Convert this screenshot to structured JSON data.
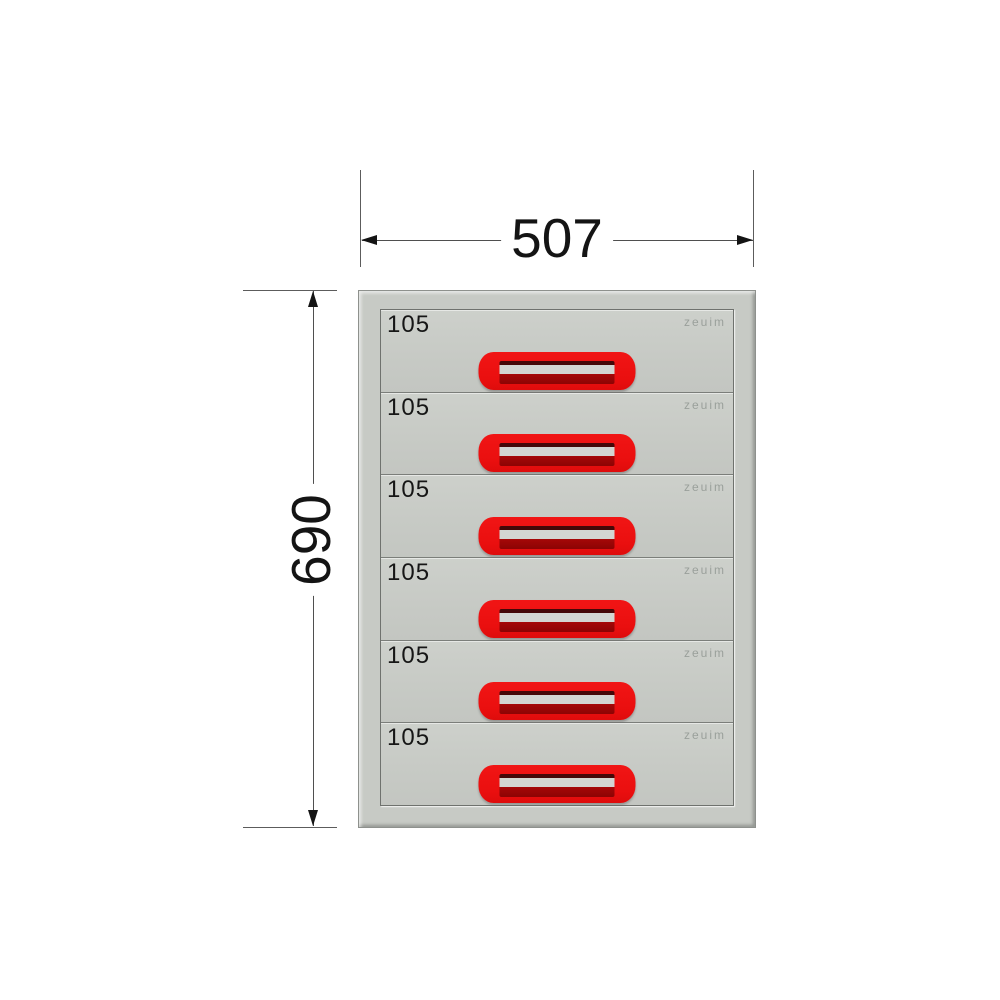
{
  "diagram": {
    "width_dimension": {
      "label": "507"
    },
    "height_dimension": {
      "label": "690"
    },
    "cabinet": {
      "drawer_count": 6,
      "drawers": [
        {
          "height_label": "105",
          "logo": "zeuim"
        },
        {
          "height_label": "105",
          "logo": "zeuim"
        },
        {
          "height_label": "105",
          "logo": "zeuim"
        },
        {
          "height_label": "105",
          "logo": "zeuim"
        },
        {
          "height_label": "105",
          "logo": "zeuim"
        },
        {
          "height_label": "105",
          "logo": "zeuim"
        }
      ]
    },
    "colors": {
      "background": "#ffffff",
      "cabinet_body": "#c7cac5",
      "drawer_panel": "#c8cbc6",
      "handle_red": "#ec1111",
      "handle_recess_dark": "#970505",
      "handle_slot": "#d3d6d2",
      "dimension_line": "#4f4f4f",
      "dimension_text": "#141414",
      "drawer_label_text": "#161616",
      "logo_text": "#9aa09b"
    }
  }
}
